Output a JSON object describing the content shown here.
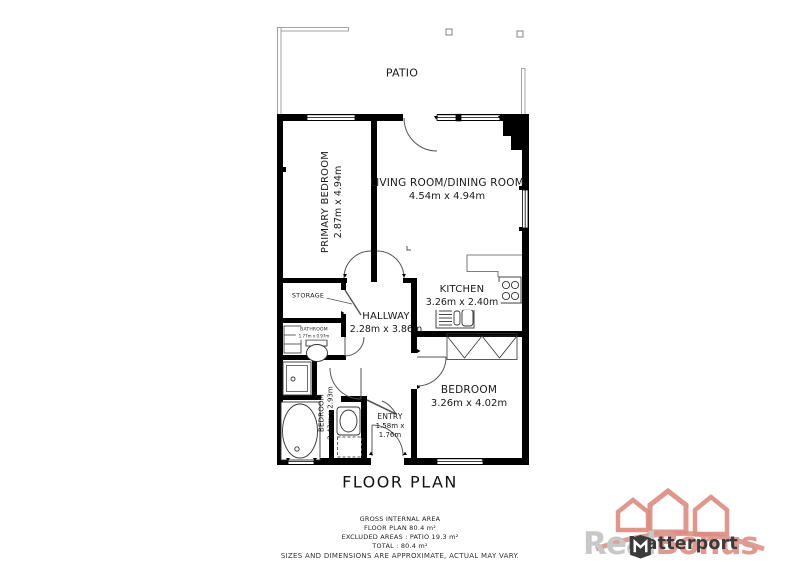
{
  "plan": {
    "title": "FLOOR PLAN",
    "rooms": {
      "patio": {
        "name": "PATIO"
      },
      "primary_bedroom": {
        "name": "PRIMARY BEDROOM",
        "dims": "2.87m x 4.94m"
      },
      "living_dining": {
        "name": "LIVING ROOM/DINING ROOM",
        "dims": "4.54m x 4.94m"
      },
      "kitchen": {
        "name": "KITCHEN",
        "dims": "3.26m x 2.40m"
      },
      "hallway": {
        "name": "HALLWAY",
        "dims": "2.28m x 3.86m"
      },
      "storage": {
        "name": "STORAGE"
      },
      "bathroom": {
        "name": "BATHROOM",
        "dims": "1.77m x 0.97m"
      },
      "bedroom_small": {
        "name": "BEDROOM",
        "dims": "2.43m x 2.93m"
      },
      "entry": {
        "name": "ENTRY",
        "dims1": "1.58m x",
        "dims2": "1.76m"
      },
      "bedroom": {
        "name": "BEDROOM",
        "dims": "3.26m x 4.02m"
      }
    },
    "summary": {
      "gross": "GROSS INTERNAL AREA",
      "floor": "FLOOR PLAN 80.4 m²",
      "excluded": "EXCLUDED AREAS :  PATIO 19.3 m²",
      "total": "TOTAL :  80.4 m²",
      "disclaimer": "SIZES AND DIMENSIONS ARE APPROXIMATE, ACTUAL MAY VARY."
    }
  },
  "branding": {
    "watermark": {
      "gray_text": "Real",
      "red_text": "Bonus"
    },
    "matterport_label": "Matterport",
    "colors": {
      "wall": "#000000",
      "thin_line": "#555555",
      "patio_line": "#999999",
      "watermark_red": "#dc9a90",
      "watermark_gray": "#c8c8c8",
      "matterport_dark": "#3b3b3b"
    }
  }
}
